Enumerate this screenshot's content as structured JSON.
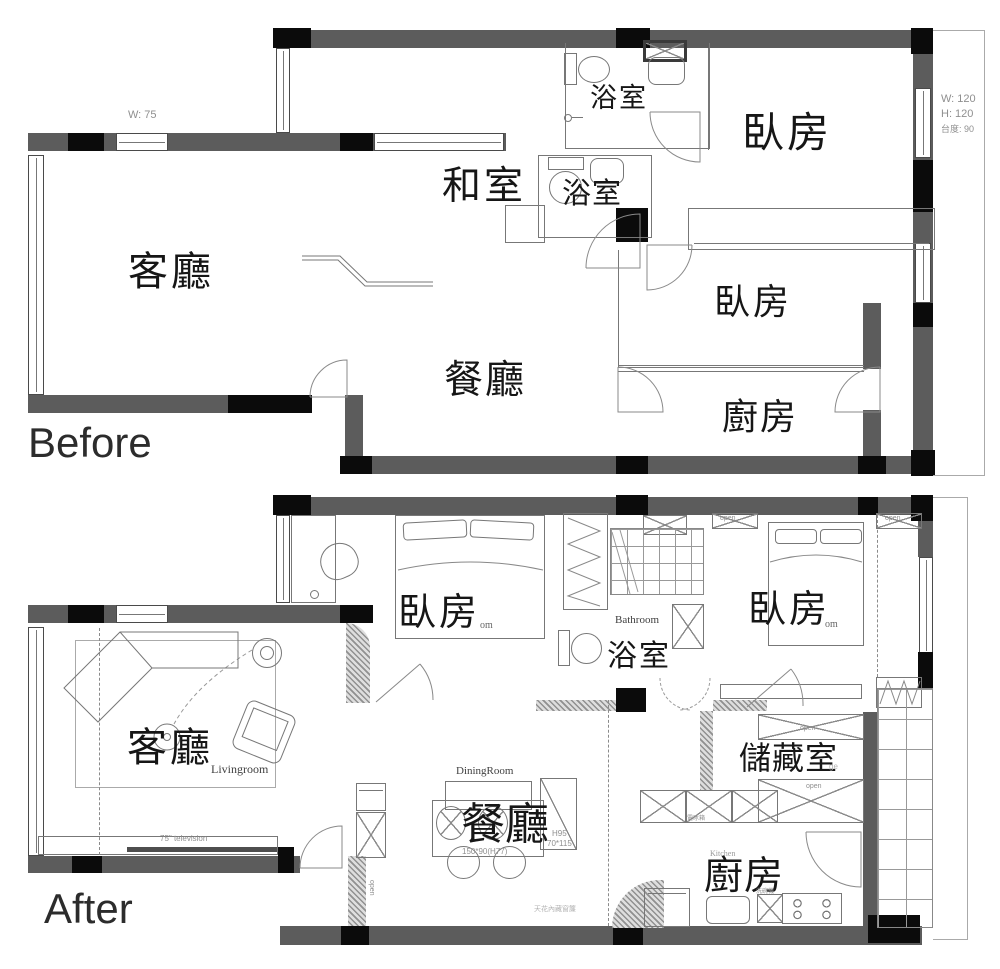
{
  "titles": {
    "before": "Before",
    "after": "After"
  },
  "before": {
    "dims": {
      "top_window": "W: 75",
      "side_w": "W: 120",
      "side_h": "H: 120",
      "side_sill": "台度: 90"
    },
    "rooms": {
      "living": "客廳",
      "tatami": "和室",
      "bath1": "浴室",
      "bath2": "浴室",
      "bed1": "臥房",
      "bed2": "臥房",
      "dining": "餐廳",
      "kitchen": "廚房"
    }
  },
  "after": {
    "rooms": {
      "living": "客廳",
      "living_en": "Livingroom",
      "bed1": "臥房",
      "bed1_sub": "om",
      "bed2": "臥房",
      "bed2_sub": "om",
      "bath": "浴室",
      "bath_en": "Bathroom",
      "dining": "餐廳",
      "dining_en": "DiningRoom",
      "kitchen": "廚房",
      "kitchen_en": "Kitchen",
      "storage": "儲藏室",
      "storage_sub": "ge"
    },
    "annotations": {
      "tv": "75\" television",
      "table_dim": "150*90(H77)",
      "cabinet_h": "H95",
      "cabinet_size": "70*115",
      "open": "open",
      "fridge": "電冰箱",
      "dishwasher": "洗碗機",
      "ceiling": "天花內藏窗簾"
    }
  }
}
